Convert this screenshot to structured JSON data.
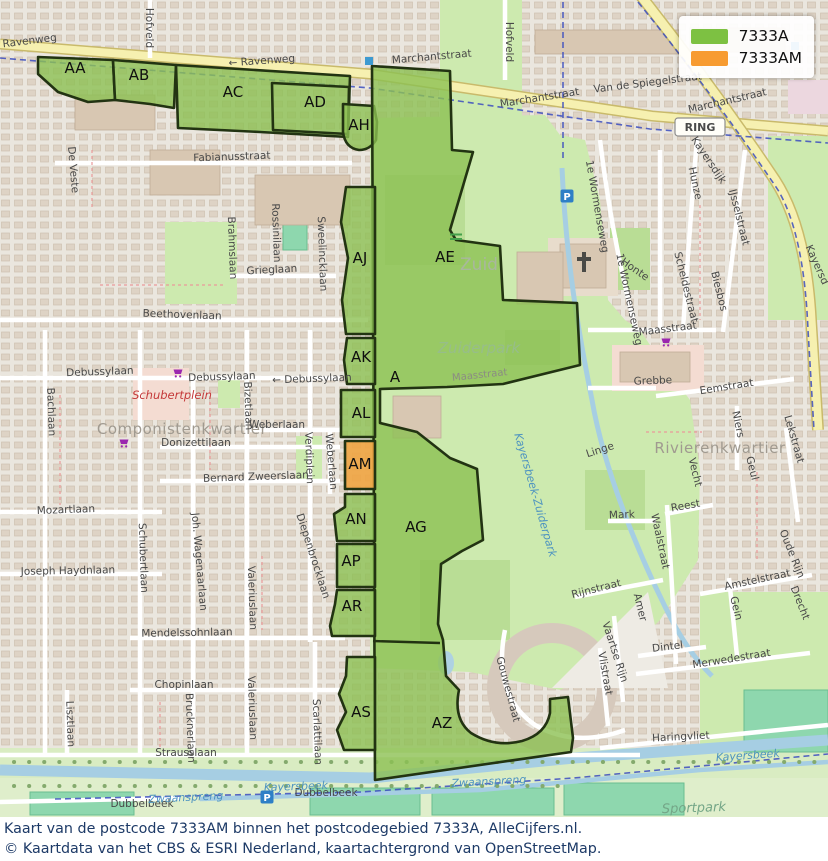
{
  "legend": {
    "items": [
      {
        "label": "7333A",
        "color": "#7dc142"
      },
      {
        "label": "7333AM",
        "color": "#f79b31"
      }
    ]
  },
  "caption": {
    "line1": "Kaart van de postcode 7333AM binnen het postcodegebied 7333A, AlleCijfers.nl.",
    "line2": "© Kaartdata van het CBS & ESRI Nederland, kaartachtergrond van OpenStreetMap."
  },
  "map": {
    "zone_colors": {
      "green": "#8cc152",
      "orange": "#efa441",
      "border": "#223312"
    },
    "zones": [
      {
        "id": "AA",
        "type": "green",
        "d": "M38,57 L113,60 L115,100 L88,102 L58,92 L38,74 Z"
      },
      {
        "id": "AB",
        "type": "green",
        "d": "M113,60 L176,65 L174,108 L150,104 L115,100 Z"
      },
      {
        "id": "AC",
        "type": "green",
        "d": "M176,65 L350,76 L348,137 L260,132 L178,128 Z"
      },
      {
        "id": "AD",
        "type": "outline",
        "d": "M272,83 L349,87 L348,134 L273,130 Z"
      },
      {
        "id": "AH",
        "type": "green",
        "d": "M343,104 L374,106 L377,122 L376,140 Q370,150 359,150 Q345,148 343,132 Z"
      },
      {
        "id": "AE",
        "type": "green",
        "d": "M372,66 L450,71 L452,150 L473,152 L450,230 L456,240 L500,246 L503,300 L577,303 L580,365 L503,384 L447,387 L380,389 L380,423 L417,432 L450,458 L477,469 L483,540 L462,551 L441,564 L438,624 L443,640 L446,676 L459,690 Q453,719 471,733 Q495,748 522,741 Q546,734 550,713 L550,699 L568,697 L573,738 L571,752 L375,780 Z"
      },
      {
        "id": "AJ",
        "type": "green",
        "d": "M346,187 L375,187 L375,334 L346,334 L342,300 L348,258 L341,222 Z"
      },
      {
        "id": "AK",
        "type": "green",
        "d": "M347,338 L375,338 L375,384 L347,384 L344,360 Z"
      },
      {
        "id": "AL",
        "type": "green",
        "d": "M341,390 L375,390 L375,437 L341,437 Z"
      },
      {
        "id": "AM",
        "type": "orange",
        "d": "M345,441 L375,441 L375,489 L345,489 Z"
      },
      {
        "id": "AN",
        "type": "green",
        "d": "M345,494 L375,494 L375,541 L337,541 L334,514 L345,507 Z"
      },
      {
        "id": "AP",
        "type": "green",
        "d": "M337,544 L375,544 L375,587 L337,587 Z"
      },
      {
        "id": "AR",
        "type": "green",
        "d": "M337,590 L375,590 L375,636 L332,636 L330,626 L335,604 Z"
      },
      {
        "id": "AS",
        "type": "green",
        "d": "M347,657 L375,657 L375,750 L344,750 L337,730 L346,712 L339,694 L346,676 Z"
      }
    ],
    "dividers": [
      "M373,641 L440,643"
    ],
    "zone_labels": [
      {
        "t": "AA",
        "x": 75,
        "y": 73
      },
      {
        "t": "AB",
        "x": 139,
        "y": 80
      },
      {
        "t": "AC",
        "x": 233,
        "y": 97
      },
      {
        "t": "AD",
        "x": 315,
        "y": 107
      },
      {
        "t": "AH",
        "x": 359,
        "y": 130
      },
      {
        "t": "AJ",
        "x": 360,
        "y": 263
      },
      {
        "t": "AE",
        "x": 445,
        "y": 262
      },
      {
        "t": "AK",
        "x": 361,
        "y": 362
      },
      {
        "t": "A",
        "x": 395,
        "y": 382
      },
      {
        "t": "AL",
        "x": 361,
        "y": 418
      },
      {
        "t": "AM",
        "x": 360,
        "y": 469
      },
      {
        "t": "AN",
        "x": 356,
        "y": 524
      },
      {
        "t": "AG",
        "x": 416,
        "y": 532
      },
      {
        "t": "AP",
        "x": 351,
        "y": 566
      },
      {
        "t": "AR",
        "x": 352,
        "y": 611
      },
      {
        "t": "AS",
        "x": 361,
        "y": 717
      },
      {
        "t": "AZ",
        "x": 442,
        "y": 728
      }
    ],
    "badges": [
      {
        "label": "RING",
        "x": 700,
        "y": 127
      }
    ],
    "icons": [
      {
        "type": "parking",
        "label": "P",
        "x": 567,
        "y": 196
      },
      {
        "type": "parking",
        "label": "P",
        "x": 267,
        "y": 797
      },
      {
        "type": "cart",
        "x": 178,
        "y": 373
      },
      {
        "type": "cart",
        "x": 124,
        "y": 443
      },
      {
        "type": "cart",
        "x": 666,
        "y": 342
      },
      {
        "type": "church",
        "x": 584,
        "y": 262
      },
      {
        "type": "busstop",
        "x": 369,
        "y": 61
      },
      {
        "type": "busstop",
        "x": 795,
        "y": 46
      },
      {
        "type": "bridge",
        "x": 456,
        "y": 237
      }
    ],
    "street_labels": [
      {
        "t": "Ravenweg",
        "x": 30,
        "y": 44,
        "r": -7,
        "c": "st"
      },
      {
        "t": "← Ravenweg",
        "x": 262,
        "y": 64,
        "r": -4,
        "c": "st"
      },
      {
        "t": "Marchantstraat",
        "x": 432,
        "y": 60,
        "r": -5,
        "c": "st"
      },
      {
        "t": "Marchantstraat",
        "x": 540,
        "y": 101,
        "r": -9,
        "c": "st"
      },
      {
        "t": "Van de Spiegelstraat",
        "x": 648,
        "y": 86,
        "r": -7,
        "c": "st"
      },
      {
        "t": "Marchantstraat",
        "x": 728,
        "y": 104,
        "r": -13,
        "c": "st"
      },
      {
        "t": "Kayersdijk",
        "x": 706,
        "y": 162,
        "r": 56,
        "c": "st"
      },
      {
        "t": "Kayersd",
        "x": 814,
        "y": 266,
        "r": 66,
        "c": "st"
      },
      {
        "t": "Hofveld",
        "x": 146,
        "y": 28,
        "r": 90,
        "c": "st"
      },
      {
        "t": "Hofveld",
        "x": 506,
        "y": 42,
        "r": 90,
        "c": "st"
      },
      {
        "t": "De Veste",
        "x": 70,
        "y": 170,
        "r": 85,
        "c": "st"
      },
      {
        "t": "Fabianusstraat",
        "x": 232,
        "y": 160,
        "r": -2,
        "c": "st"
      },
      {
        "t": "Brahmslaan",
        "x": 229,
        "y": 248,
        "r": 88,
        "c": "st"
      },
      {
        "t": "Rossinilaan",
        "x": 273,
        "y": 233,
        "r": 88,
        "c": "st"
      },
      {
        "t": "Sweelincklaan",
        "x": 319,
        "y": 254,
        "r": 88,
        "c": "st"
      },
      {
        "t": "Grieglaan",
        "x": 272,
        "y": 273,
        "r": -3,
        "c": "st"
      },
      {
        "t": "Beethovenlaan",
        "x": 182,
        "y": 318,
        "r": 2,
        "c": "st"
      },
      {
        "t": "Debussylaan",
        "x": 100,
        "y": 375,
        "r": -2,
        "c": "st"
      },
      {
        "t": "Debussylaan",
        "x": 222,
        "y": 380,
        "r": -2,
        "c": "st"
      },
      {
        "t": "← Debussylaan",
        "x": 312,
        "y": 382,
        "r": -2,
        "c": "st"
      },
      {
        "t": "Schubertplein",
        "x": 172,
        "y": 399,
        "r": 0,
        "c": "red"
      },
      {
        "t": "Componistenkwartier",
        "x": 182,
        "y": 434,
        "r": 0,
        "c": "area"
      },
      {
        "t": "Donizettilaan",
        "x": 196,
        "y": 446,
        "r": 0,
        "c": "st"
      },
      {
        "t": "Weberlaan",
        "x": 277,
        "y": 428,
        "r": 0,
        "c": "st"
      },
      {
        "t": "Bizetlaan",
        "x": 245,
        "y": 406,
        "r": 88,
        "c": "st"
      },
      {
        "t": "Weberlaan",
        "x": 328,
        "y": 462,
        "r": 85,
        "c": "st"
      },
      {
        "t": "Verdiplein",
        "x": 306,
        "y": 458,
        "r": 88,
        "c": "st"
      },
      {
        "t": "Bernard Zweerslaan",
        "x": 256,
        "y": 480,
        "r": -2,
        "c": "st"
      },
      {
        "t": "Bachlaan",
        "x": 48,
        "y": 412,
        "r": 88,
        "c": "st"
      },
      {
        "t": "Mozartlaan",
        "x": 66,
        "y": 513,
        "r": -2,
        "c": "st"
      },
      {
        "t": "Schubertlaan",
        "x": 140,
        "y": 558,
        "r": 88,
        "c": "st"
      },
      {
        "t": "Joh. Wagenaarlaan",
        "x": 196,
        "y": 562,
        "r": 85,
        "c": "st"
      },
      {
        "t": "Valeriuslaan",
        "x": 249,
        "y": 598,
        "r": 88,
        "c": "st"
      },
      {
        "t": "Diepenbrocklaan",
        "x": 310,
        "y": 557,
        "r": 72,
        "c": "st"
      },
      {
        "t": "Joseph Haydnlaan",
        "x": 68,
        "y": 574,
        "r": -1,
        "c": "st"
      },
      {
        "t": "Mendelssohnlaan",
        "x": 187,
        "y": 636,
        "r": -1,
        "c": "st"
      },
      {
        "t": "Chopinlaan",
        "x": 184,
        "y": 688,
        "r": 0,
        "c": "st"
      },
      {
        "t": "Lisztlaan",
        "x": 67,
        "y": 724,
        "r": 88,
        "c": "st"
      },
      {
        "t": "Brucknerlaan",
        "x": 187,
        "y": 728,
        "r": 88,
        "c": "st"
      },
      {
        "t": "Valeriuslaan",
        "x": 249,
        "y": 708,
        "r": 88,
        "c": "st"
      },
      {
        "t": "Scarlattilaan",
        "x": 314,
        "y": 732,
        "r": 88,
        "c": "st"
      },
      {
        "t": "Strausslaan",
        "x": 186,
        "y": 756,
        "r": 0,
        "c": "st"
      },
      {
        "t": "Dubbelbeek",
        "x": 142,
        "y": 807,
        "r": 0,
        "c": "st"
      },
      {
        "t": "Dubbelbeek",
        "x": 326,
        "y": 796,
        "r": 0,
        "c": "st"
      },
      {
        "t": "Kayersbeek",
        "x": 296,
        "y": 790,
        "r": -2,
        "c": "water"
      },
      {
        "t": "Zwaanspreng",
        "x": 186,
        "y": 801,
        "r": -3,
        "c": "water"
      },
      {
        "t": "Zwaanspreng",
        "x": 489,
        "y": 785,
        "r": -3,
        "c": "water"
      },
      {
        "t": "Kayersbeek",
        "x": 748,
        "y": 759,
        "r": -4,
        "c": "water"
      },
      {
        "t": "Sportpark",
        "x": 694,
        "y": 812,
        "r": -2,
        "c": "parkit"
      },
      {
        "t": "Haringvliet",
        "x": 681,
        "y": 740,
        "r": -3,
        "c": "st"
      },
      {
        "t": "Gouwestraat",
        "x": 505,
        "y": 690,
        "r": 75,
        "c": "st"
      },
      {
        "t": "Zuid",
        "x": 479,
        "y": 270,
        "r": 0,
        "c": "zuid"
      },
      {
        "t": "Zuiderpark",
        "x": 479,
        "y": 353,
        "r": 0,
        "c": "zpark"
      },
      {
        "t": "Kayersbeek-Zuiderpark",
        "x": 532,
        "y": 496,
        "r": 74,
        "c": "water"
      },
      {
        "t": "Maasstraat",
        "x": 480,
        "y": 378,
        "r": -6,
        "c": "faint"
      },
      {
        "t": "1e Wormenseweg",
        "x": 594,
        "y": 207,
        "r": 80,
        "c": "st"
      },
      {
        "t": "1e Wormenseweg",
        "x": 626,
        "y": 300,
        "r": 78,
        "c": "st"
      },
      {
        "t": "Honte",
        "x": 633,
        "y": 272,
        "r": 35,
        "c": "st"
      },
      {
        "t": "Hunze",
        "x": 692,
        "y": 184,
        "r": 78,
        "c": "st"
      },
      {
        "t": "IJsselstraat",
        "x": 736,
        "y": 218,
        "r": 76,
        "c": "st"
      },
      {
        "t": "Scheldestraat",
        "x": 683,
        "y": 288,
        "r": 76,
        "c": "st"
      },
      {
        "t": "Biesbos",
        "x": 716,
        "y": 292,
        "r": 76,
        "c": "st"
      },
      {
        "t": "Maasstraat",
        "x": 668,
        "y": 332,
        "r": -7,
        "c": "st"
      },
      {
        "t": "Grebbe",
        "x": 653,
        "y": 384,
        "r": -2,
        "c": "st"
      },
      {
        "t": "Eemstraat",
        "x": 727,
        "y": 390,
        "r": -9,
        "c": "st"
      },
      {
        "t": "Niers",
        "x": 735,
        "y": 425,
        "r": 78,
        "c": "st"
      },
      {
        "t": "Lekstraat",
        "x": 791,
        "y": 440,
        "r": 74,
        "c": "st"
      },
      {
        "t": "Rivierenkwartier",
        "x": 720,
        "y": 453,
        "r": 0,
        "c": "area"
      },
      {
        "t": "Linge",
        "x": 601,
        "y": 453,
        "r": -18,
        "c": "st"
      },
      {
        "t": "Vecht",
        "x": 692,
        "y": 473,
        "r": 76,
        "c": "st"
      },
      {
        "t": "Geul",
        "x": 749,
        "y": 469,
        "r": 76,
        "c": "st"
      },
      {
        "t": "Mark",
        "x": 622,
        "y": 518,
        "r": -2,
        "c": "st"
      },
      {
        "t": "Reest",
        "x": 686,
        "y": 509,
        "r": -10,
        "c": "st"
      },
      {
        "t": "Waalstraat",
        "x": 657,
        "y": 542,
        "r": 78,
        "c": "st"
      },
      {
        "t": "Rijnstraat",
        "x": 597,
        "y": 592,
        "r": -14,
        "c": "st"
      },
      {
        "t": "Amer",
        "x": 637,
        "y": 608,
        "r": 76,
        "c": "st"
      },
      {
        "t": "Amstelstraat",
        "x": 758,
        "y": 583,
        "r": -12,
        "c": "st"
      },
      {
        "t": "Gein",
        "x": 733,
        "y": 609,
        "r": 76,
        "c": "st"
      },
      {
        "t": "Oude Rijn",
        "x": 789,
        "y": 555,
        "r": 68,
        "c": "st"
      },
      {
        "t": "Drecht",
        "x": 797,
        "y": 604,
        "r": 68,
        "c": "st"
      },
      {
        "t": "Dintel",
        "x": 668,
        "y": 650,
        "r": -7,
        "c": "st"
      },
      {
        "t": "Merwedestraat",
        "x": 732,
        "y": 662,
        "r": -9,
        "c": "st"
      },
      {
        "t": "Vlistraat",
        "x": 602,
        "y": 674,
        "r": 80,
        "c": "st"
      },
      {
        "t": "Vaartse Rijn",
        "x": 612,
        "y": 653,
        "r": 72,
        "c": "st"
      }
    ]
  }
}
